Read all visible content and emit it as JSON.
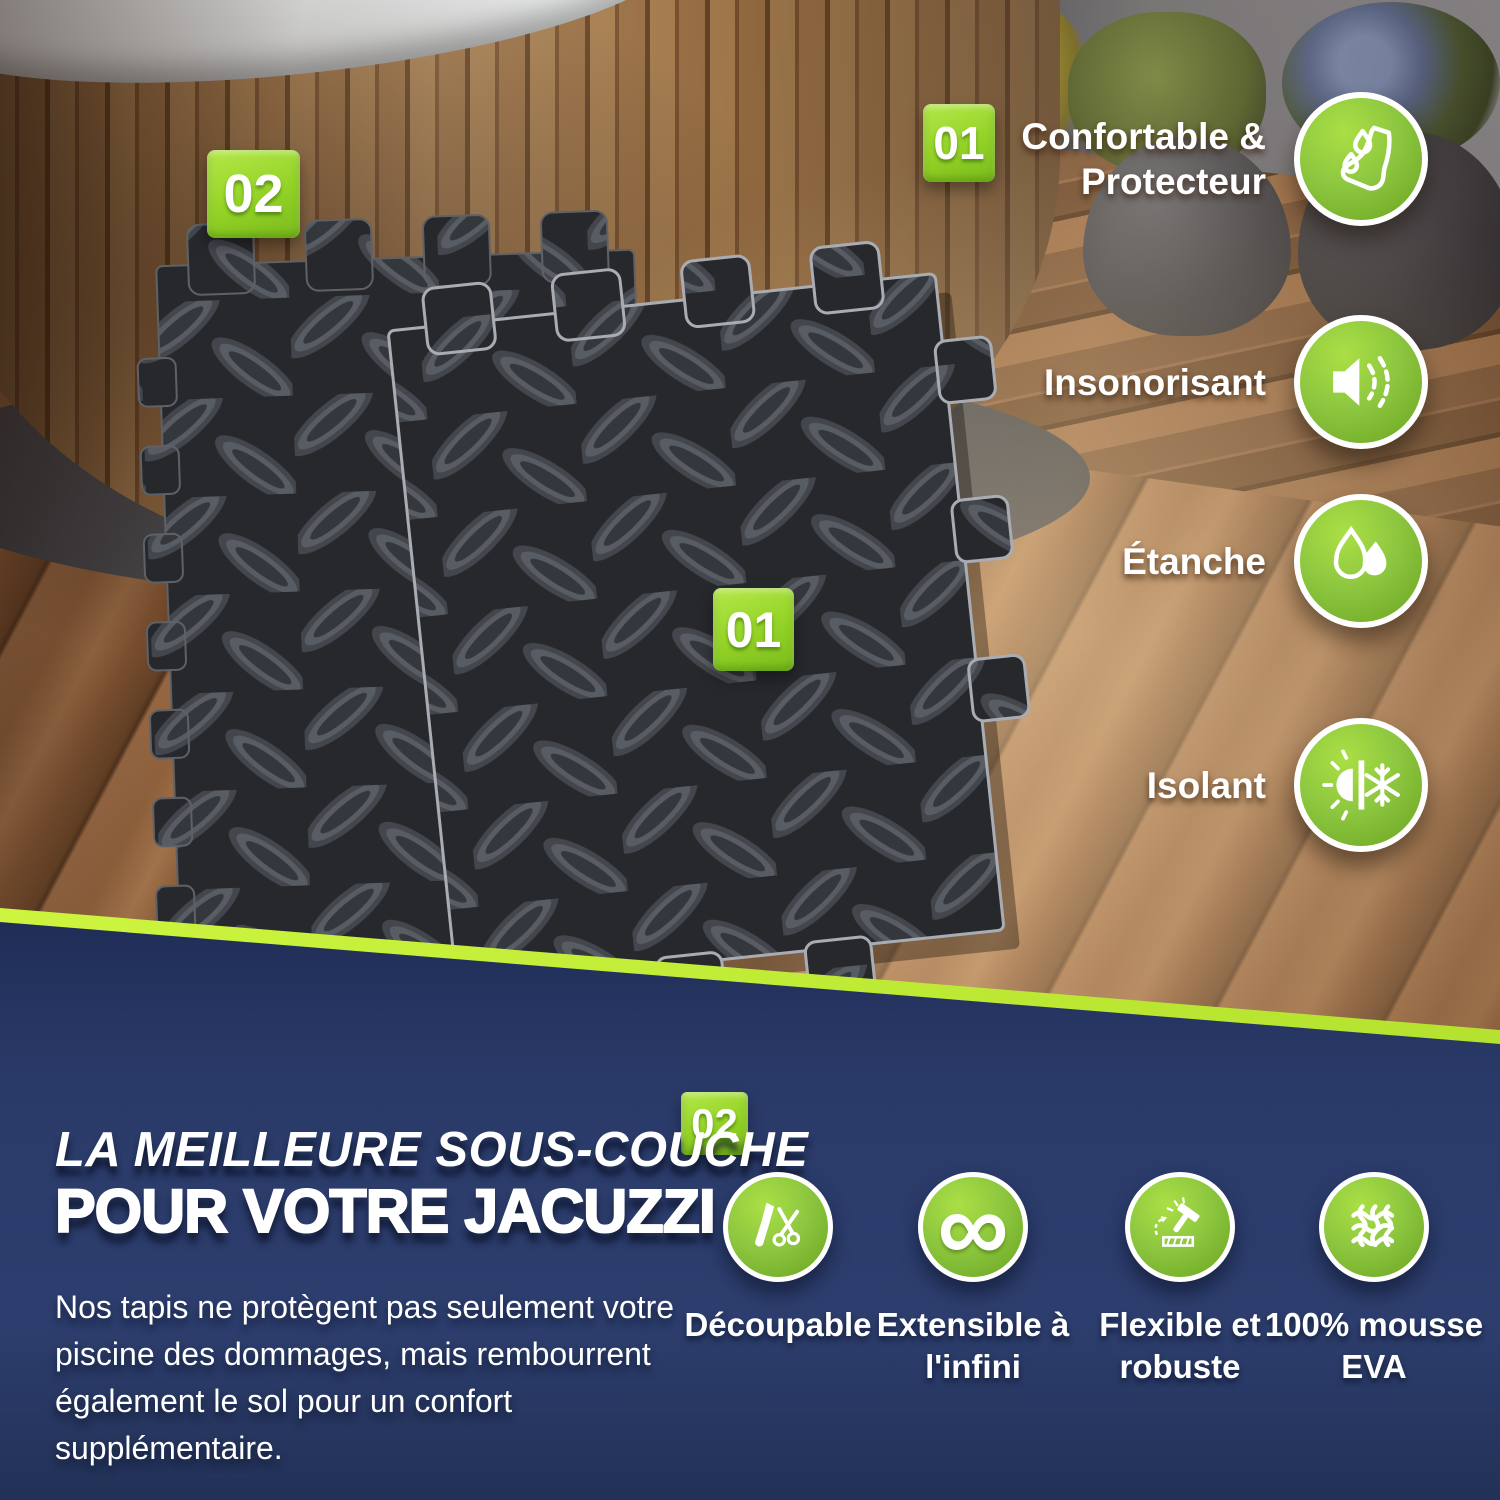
{
  "colors": {
    "accent_green": "#8cc63f",
    "accent_green_light": "#aadd45",
    "accent_green_dark": "#6aa31f",
    "lime_stripe": "#c6f23c",
    "navy_background": "#2a3a68",
    "text_white": "#ffffff",
    "mat_dark": "#27292d"
  },
  "hero": {
    "badge_back_mat": "02",
    "badge_front_mat": "01",
    "badge_feature_group": "01",
    "features": [
      {
        "icon": "foot-drops-icon",
        "lines": [
          "Confortable &",
          "Protecteur"
        ]
      },
      {
        "icon": "speaker-icon",
        "lines": [
          "Insonorisant"
        ]
      },
      {
        "icon": "water-drops-icon",
        "lines": [
          "Étanche"
        ]
      },
      {
        "icon": "sun-snowflake-icon",
        "lines": [
          "Isolant"
        ]
      }
    ]
  },
  "info": {
    "badge": "02",
    "title_line1": "LA MEILLEURE SOUS-COUCHE",
    "title_line2": "POUR VOTRE JACUZZI",
    "paragraph_lines": [
      "Nos tapis ne protègent pas seulement votre",
      "piscine des dommages, mais rembourrent",
      "également le sol pour un confort",
      "supplémentaire."
    ],
    "features": [
      {
        "icon": "cutter-scissors-icon",
        "lines": [
          "Découpable"
        ]
      },
      {
        "icon": "infinity-icon",
        "symbol": "∞",
        "lines": [
          "Extensible à",
          "l'infini"
        ]
      },
      {
        "icon": "hammer-icon",
        "lines": [
          "Flexible et",
          "robuste"
        ]
      },
      {
        "icon": "eva-foam-mesh-icon",
        "lines": [
          "100% mousse",
          "EVA"
        ]
      }
    ]
  }
}
